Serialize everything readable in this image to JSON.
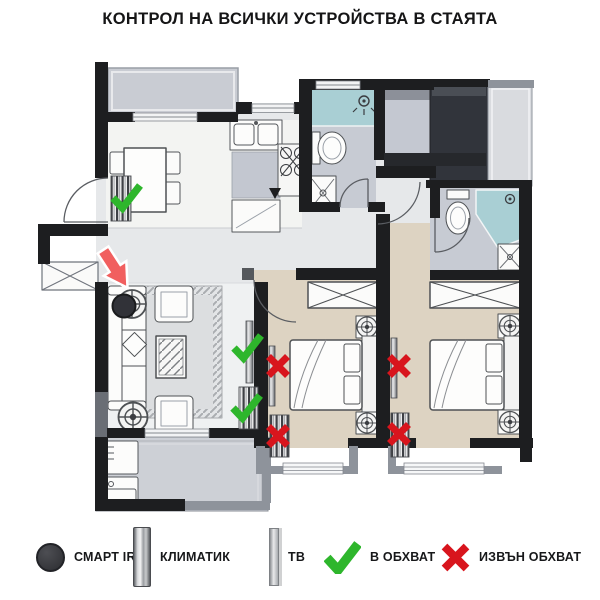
{
  "title": "КОНТРОЛ НА ВСИЧКИ УСТРОЙСТВА В СТАЯТА",
  "colors": {
    "in_range": "#2eb62c",
    "out_of_range": "#d8151d",
    "arrow": "#f15f5f",
    "smart_ir": "#313238"
  },
  "legend": {
    "items": [
      {
        "icon": "smart-ir-dot-icon",
        "label": "СМАРТ IR"
      },
      {
        "icon": "ac-unit-icon",
        "label": "КЛИМАТИК"
      },
      {
        "icon": "tv-icon",
        "label": "ТВ"
      },
      {
        "icon": "check-icon",
        "label": "В ОБХВАТ"
      },
      {
        "icon": "cross-icon",
        "label": "ИЗВЪН ОБХВАТ"
      }
    ]
  },
  "floorplan": {
    "smart_ir": {
      "x": 124,
      "y": 306
    },
    "arrow": {
      "x": 103,
      "y": 250,
      "rotation_deg": -33
    },
    "markers": [
      {
        "device": "ac-dining",
        "icon": "check-mark",
        "status": "в обхват",
        "x": 126,
        "y": 197
      },
      {
        "device": "tv-living-room",
        "icon": "check-mark",
        "status": "в обхват",
        "x": 247,
        "y": 347
      },
      {
        "device": "ac-living-room",
        "icon": "check-mark",
        "status": "в обхват",
        "x": 246,
        "y": 407
      },
      {
        "device": "tv-bedroom-1",
        "icon": "cross-mark",
        "status": "извън обхват",
        "x": 278,
        "y": 366
      },
      {
        "device": "ac-bedroom-1",
        "icon": "cross-mark",
        "status": "извън обхват",
        "x": 278,
        "y": 436
      },
      {
        "device": "tv-bedroom-2",
        "icon": "cross-mark",
        "status": "извън обхват",
        "x": 399,
        "y": 366
      },
      {
        "device": "ac-bedroom-2",
        "icon": "cross-mark",
        "status": "извън обхват",
        "x": 399,
        "y": 434
      }
    ]
  }
}
